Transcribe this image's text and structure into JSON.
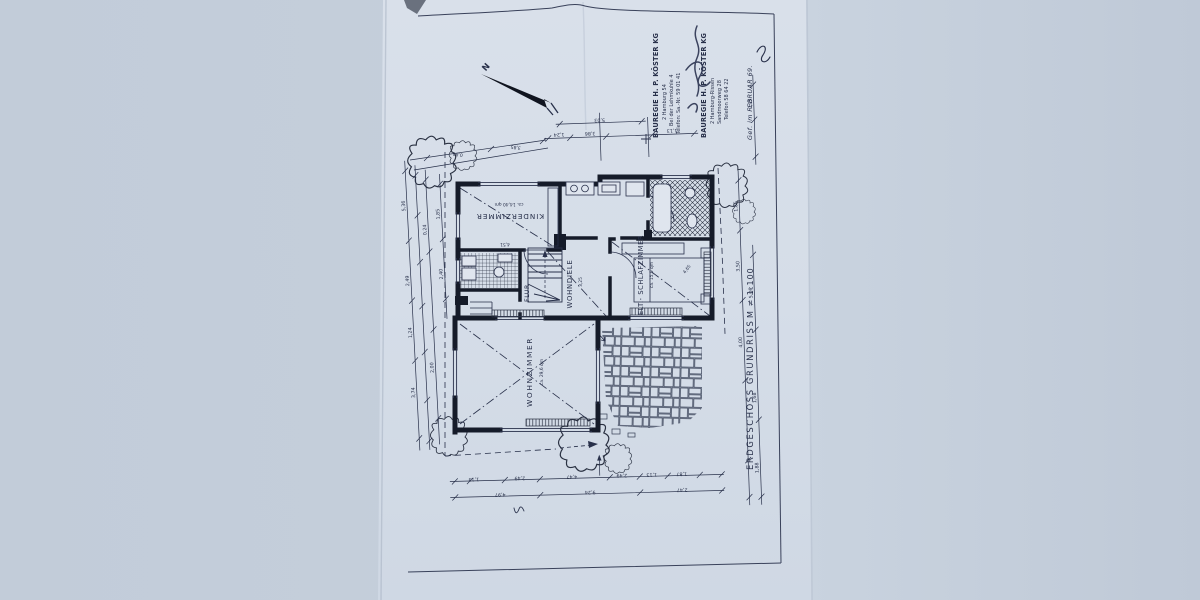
{
  "scene": {
    "description": "Photograph of a paper architectural drawing, ground floor plan, rotated 90 degrees on the page",
    "document_kind": "floor plan blueprint"
  },
  "title_block": {
    "title": "ERDGESCHOSS GRUNDRISS",
    "scale": "M ≠ 1:100"
  },
  "north_arrow": {
    "label": "N"
  },
  "stamps": {
    "s1": {
      "line1": "BAUREGIE H. P. KÖSTER KG",
      "line2": "2 Hamburg 54",
      "line3": "Bei der Lehmkuhle 4",
      "line4": "Telefon: Sa.-Nr. 59 01 41"
    },
    "s2": {
      "line1": "BAUREGIE H. P. KÖSTER KG",
      "line2": "2 Hamburg-Rissen",
      "line3": "Sandmoorweg 28",
      "line4": "Telefon 58 64 22"
    },
    "note": "Gef. im FEBRUAR 69."
  },
  "rooms": {
    "kinder": {
      "label": "KINDERZIMMER",
      "area": "ca. 14,40 qm"
    },
    "schlaf": {
      "label": "ELT.- SCHLAFZIMMER",
      "area": "ca. 15,9 qm"
    },
    "wohndiele": {
      "label": "WOHNDIELE"
    },
    "flur": {
      "label": "FLUR"
    },
    "wohnzimmer": {
      "label": "WOHNZIMMER",
      "area": "ca. 29,6 qm"
    }
  },
  "dims": {
    "top": [
      "1,24",
      "3,86",
      "1,13"
    ],
    "top2": "5,03",
    "diag": [
      "0,80",
      "3,85"
    ],
    "left": [
      "5,36",
      "0,24",
      "2,49",
      "1,24",
      "3,74",
      "2,00"
    ],
    "left2": [
      "1,85",
      "2,40"
    ],
    "right": [
      "1,85",
      "3,50",
      "4,00"
    ],
    "right2": [
      "5,06",
      "1,68",
      "1,88"
    ],
    "right3": "0,95",
    "bottom": [
      "1,13",
      "2,49",
      "4,47",
      "2,49",
      "1,13",
      "1,87"
    ],
    "bottom2": [
      "4,97",
      "9,24",
      "2,47"
    ],
    "inner": {
      "kinder": "4,51",
      "schlaf": "4,65",
      "diele": "3,25"
    }
  },
  "colors": {
    "background": "#c5cfdc",
    "paper": "#d6dee8",
    "ink": "#28304a",
    "wall": "#151b29"
  }
}
